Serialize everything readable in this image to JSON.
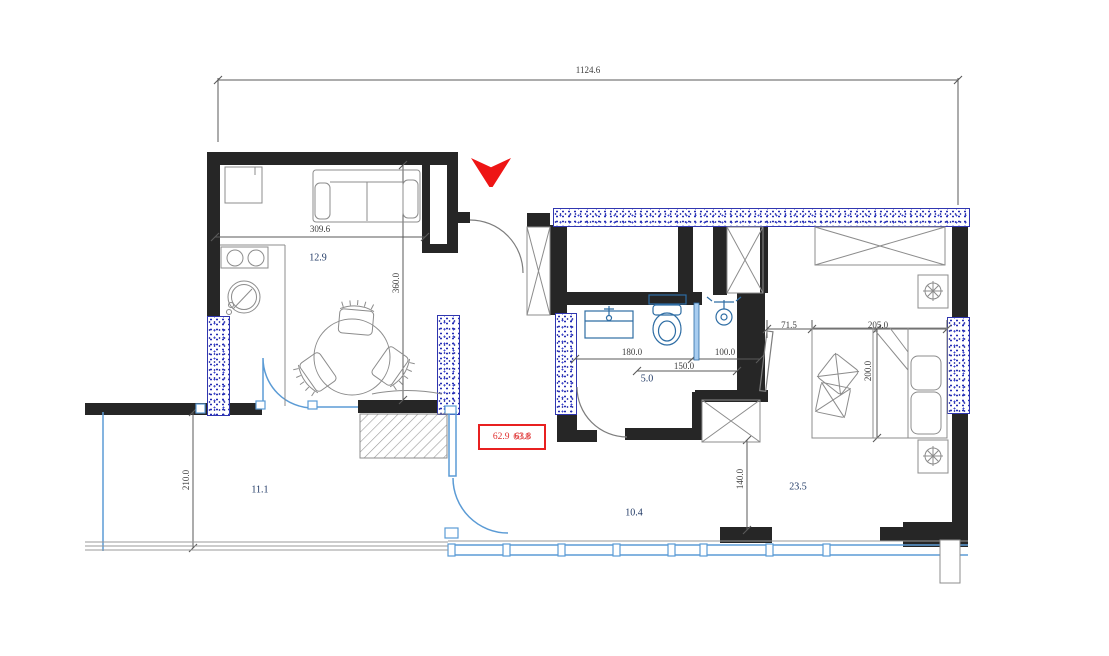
{
  "floorplan": {
    "title": "apartment-floor-plan",
    "overall_width": "1124.6",
    "total_area_box": {
      "value_a": "62.9",
      "value_b": "63.8"
    },
    "rooms": {
      "living_kitchen": {
        "area": "12.9",
        "width": "309.6",
        "height": "360.0"
      },
      "terrace": {
        "area": "11.1",
        "height": "210.0"
      },
      "hall": {
        "area": "10.4",
        "height": "140.0"
      },
      "bathroom": {
        "area": "5.0",
        "width": "180.0",
        "inner_width": "150.0",
        "shower_width": "100.0"
      },
      "bedroom": {
        "area": "23.5",
        "door_gap": "71.5",
        "bed_width": "205.0",
        "bed_length": "200.0"
      }
    },
    "icons": {
      "entrance": "entrance-arrow-icon"
    },
    "colors": {
      "wall": "#262626",
      "insulation_dots": "#232cb5",
      "window_blue": "#5b9bd5",
      "fixture_blue": "#2e6da4",
      "accent_red": "#e82020",
      "area_label": "#1f3864",
      "dimension_text": "#3c3c3c"
    }
  }
}
